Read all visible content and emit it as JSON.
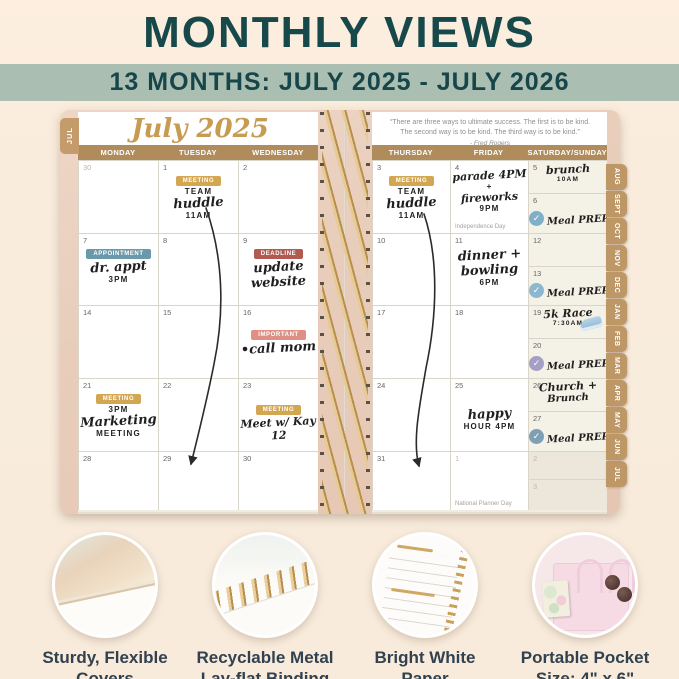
{
  "header": {
    "title": "MONTHLY VIEWS",
    "subtitle": "13 MONTHS: JULY 2025 - JULY 2026"
  },
  "colors": {
    "title_teal": "#17494b",
    "banner_sage": "#aabfb1",
    "tab_tan": "#bd9765",
    "badge_gold": "#d3a652",
    "badge_teal": "#6999ab",
    "badge_brick": "#b05a50",
    "badge_salmon": "#dd9083",
    "check_blue": "#7fb0c8"
  },
  "planner": {
    "month_title": "July 2025",
    "current_tab": "JUL",
    "check_glyph": "✓",
    "quote": {
      "line1": "“There are three ways to ultimate success. The first is to be kind.",
      "line2": "The second way is to be kind. The third way is to be kind.”",
      "attribution": "- Fred Rogers"
    },
    "day_headers": {
      "left": [
        "MONDAY",
        "TUESDAY",
        "WEDNESDAY"
      ],
      "right": [
        "THURSDAY",
        "FRIDAY",
        "SATURDAY/SUNDAY"
      ]
    },
    "month_tabs": [
      "AUG",
      "SEPT",
      "OCT",
      "NOV",
      "DEC",
      "JAN",
      "FEB",
      "MAR",
      "APR",
      "MAY",
      "JUN",
      "JUL"
    ],
    "cells": {
      "jun30": {
        "date": "30"
      },
      "jul1": {
        "date": "1",
        "badge": "MEETING",
        "l1": "TEAM",
        "l2": "huddle",
        "l3": "11AM"
      },
      "jul2": {
        "date": "2"
      },
      "jul7": {
        "date": "7",
        "badge": "APPOINTMENT",
        "l1": "dr. appt",
        "l2": "3PM"
      },
      "jul8": {
        "date": "8"
      },
      "jul9": {
        "date": "9",
        "badge": "DEADLINE",
        "l1": "update",
        "l2": "website"
      },
      "jul14": {
        "date": "14"
      },
      "jul15": {
        "date": "15"
      },
      "jul16": {
        "date": "16",
        "badge": "IMPORTANT",
        "l1": "•call mom"
      },
      "jul21": {
        "date": "21",
        "badge": "MEETING",
        "l1": "3PM",
        "l2": "Marketing",
        "l3": "MEETING"
      },
      "jul22": {
        "date": "22"
      },
      "jul23": {
        "date": "23",
        "badge": "MEETING",
        "l1": "Meet w/ Kay 12"
      },
      "jul28": {
        "date": "28"
      },
      "jul29": {
        "date": "29"
      },
      "jul30": {
        "date": "30"
      },
      "jul3": {
        "date": "3",
        "badge": "MEETING",
        "l1": "TEAM",
        "l2": "huddle",
        "l3": "11AM"
      },
      "jul4": {
        "date": "4",
        "l1": "parade 4PM",
        "l2": "+",
        "l3": "fireworks",
        "l4": "9PM",
        "holiday": "Independence Day"
      },
      "jul5": {
        "date": "5",
        "l1": "brunch",
        "l2": "10AM"
      },
      "jul6": {
        "date": "6",
        "task": "Meal PREP"
      },
      "jul10": {
        "date": "10"
      },
      "jul11": {
        "date": "11",
        "l1": "dinner +",
        "l2": "bowling",
        "l3": "6PM"
      },
      "jul12": {
        "date": "12"
      },
      "jul13": {
        "date": "13",
        "task": "Meal PREP"
      },
      "jul17": {
        "date": "17"
      },
      "jul18": {
        "date": "18"
      },
      "jul19": {
        "date": "19",
        "l1": "5k Race",
        "l2": "7:30AM"
      },
      "jul20": {
        "date": "20",
        "task": "Meal PREP"
      },
      "jul24": {
        "date": "24"
      },
      "jul25": {
        "date": "25",
        "l1": "happy",
        "l2": "HOUR  4PM"
      },
      "jul26": {
        "date": "26",
        "l1": "Church +",
        "l2": "Brunch"
      },
      "jul27": {
        "date": "27",
        "task": "Meal PREP"
      },
      "jul31": {
        "date": "31"
      },
      "aug1": {
        "date": "1",
        "holiday": "National Planner Day"
      },
      "aug2": {
        "date": "2"
      },
      "aug3": {
        "date": "3"
      }
    }
  },
  "features": [
    {
      "caption_line1": "Sturdy, Flexible",
      "caption_line2": "Covers"
    },
    {
      "caption_line1": "Recyclable Metal",
      "caption_line2": "Lay-flat Binding"
    },
    {
      "caption_line1": "Bright White",
      "caption_line2": "Paper"
    },
    {
      "caption_line1": "Portable Pocket",
      "caption_line2": "Size: 4\" x 6\""
    }
  ]
}
